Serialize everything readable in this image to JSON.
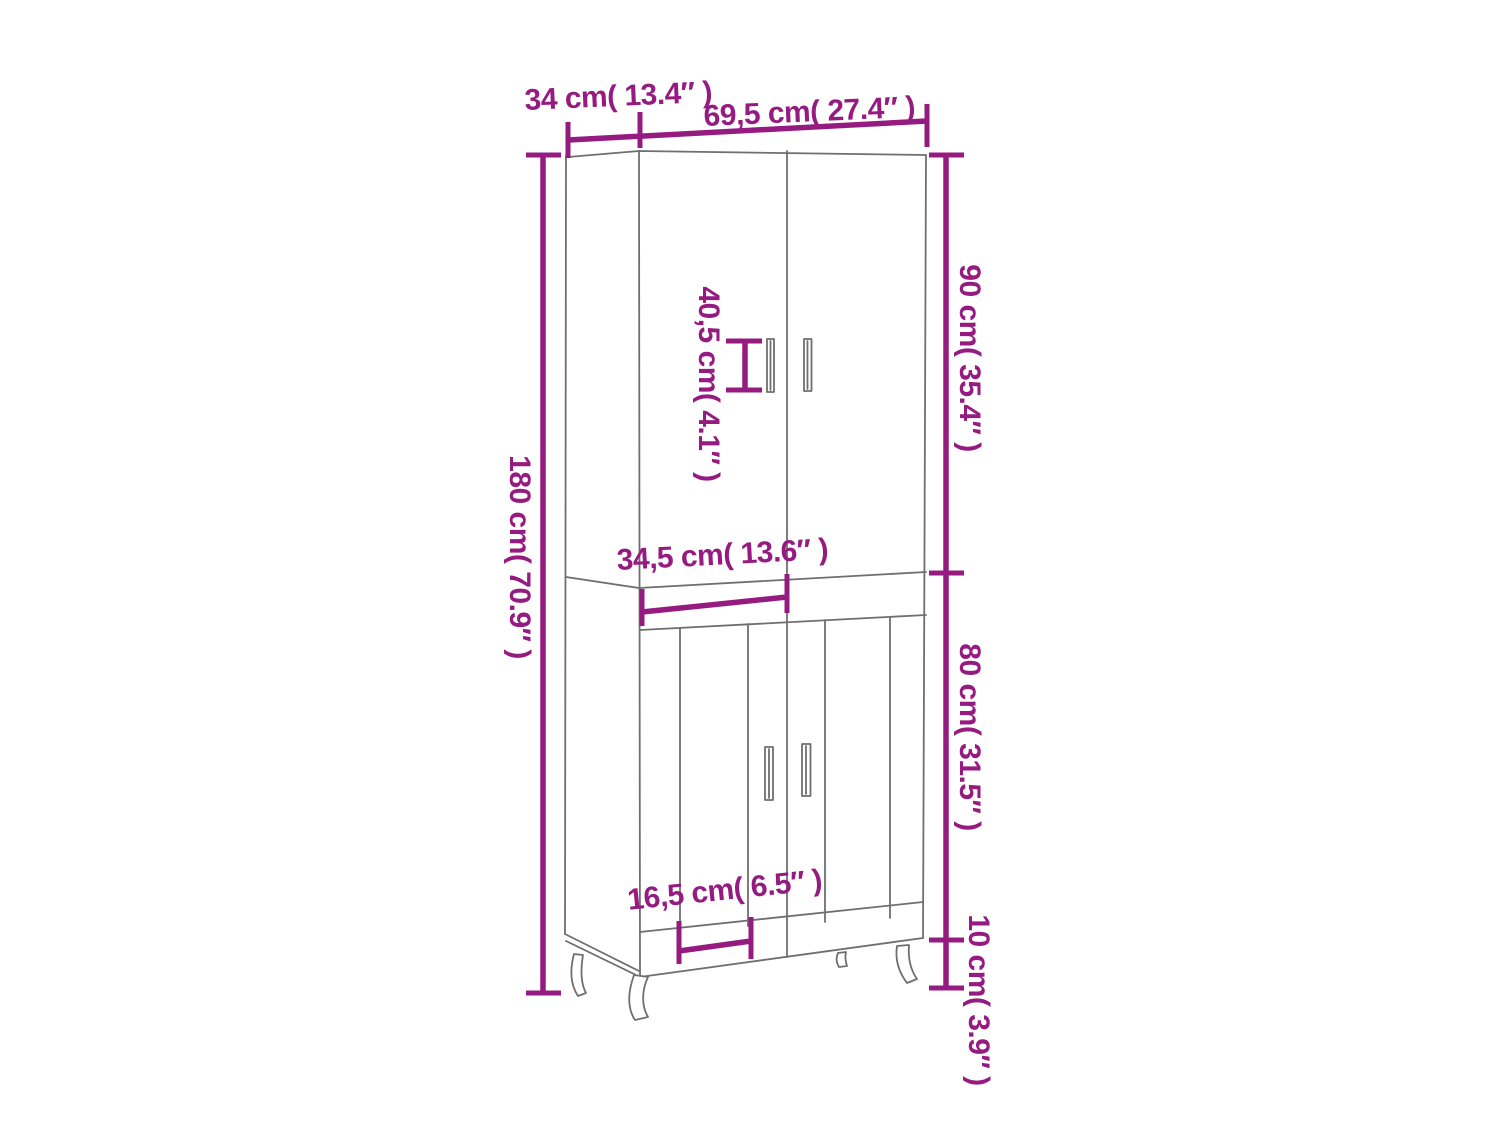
{
  "diagram": {
    "type": "furniture-dimension-diagram",
    "subject": "two-section highboard cabinet with four doors and splayed legs",
    "colors": {
      "dimension": "#951b81",
      "outline": "#6f6f6f",
      "background": "#ffffff"
    },
    "labels": {
      "top_depth": "34 cm( 13.4″ )",
      "top_width": "69,5 cm( 27.4″ )",
      "total_height": "180 cm( 70.9″ )",
      "upper_height": "90 cm( 35.4″ )",
      "handle_spacing": "40,5 cm( 4.1″ )",
      "middle_width": "34,5 cm( 13.6″ )",
      "lower_height": "80 cm( 31.5″ )",
      "leg_height": "10 cm( 3.9″ )",
      "bottom_width": "16,5 cm( 6.5″ )"
    }
  }
}
